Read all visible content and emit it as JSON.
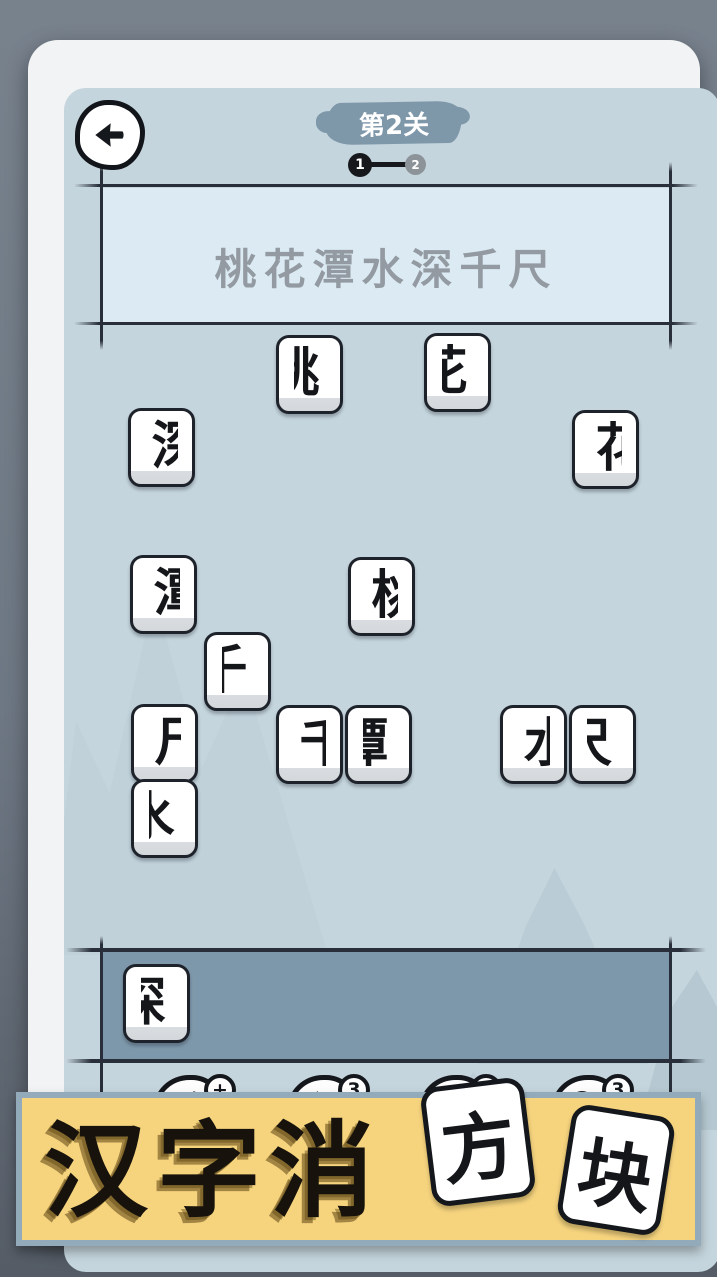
{
  "colors": {
    "screen_bg": "#c5d5dd",
    "phrase_fill": "#dcebf3",
    "tray_fill": "#7e98ab",
    "banner_bg": "#f6d47e",
    "banner_border": "#93aaba",
    "level_banner": "#7e98aa",
    "ink": "#14171c",
    "phrase_text": "#939aa2"
  },
  "header": {
    "back_icon": "arrow-left-icon",
    "level_label": "第2关",
    "progress": {
      "current": "1",
      "next": "2"
    }
  },
  "puzzle": {
    "phrase": "桃花潭水深千尺"
  },
  "board": {
    "tiles": [
      {
        "char": "桃",
        "half": "right",
        "x": 248,
        "y": 295
      },
      {
        "char": "花",
        "half": "right",
        "x": 396,
        "y": 293
      },
      {
        "char": "深",
        "half": "left",
        "x": 100,
        "y": 368
      },
      {
        "char": "花",
        "half": "left",
        "x": 544,
        "y": 370
      },
      {
        "char": "潭",
        "half": "left",
        "x": 102,
        "y": 515
      },
      {
        "char": "桃",
        "half": "left",
        "x": 320,
        "y": 517
      },
      {
        "char": "千",
        "half": "right",
        "x": 176,
        "y": 592
      },
      {
        "char": "尺",
        "half": "left",
        "x": 103,
        "y": 664
      },
      {
        "char": "千",
        "half": "left",
        "x": 248,
        "y": 665
      },
      {
        "char": "潭",
        "half": "right",
        "x": 317,
        "y": 665
      },
      {
        "char": "水",
        "half": "left",
        "x": 472,
        "y": 665
      },
      {
        "char": "尺",
        "half": "right",
        "x": 541,
        "y": 665
      },
      {
        "char": "水",
        "half": "right",
        "x": 103,
        "y": 739
      }
    ]
  },
  "tray": {
    "tiles": [
      {
        "char": "深",
        "half": "right",
        "x": 95,
        "y": 924
      }
    ]
  },
  "toolbar": {
    "buttons": [
      {
        "name": "swap",
        "icon": "swap-arrows-icon",
        "badge": "+"
      },
      {
        "name": "undo",
        "icon": "undo-arrow-icon",
        "badge": "3"
      },
      {
        "name": "add-tile",
        "icon": "plus-blocks-icon",
        "badge": "+"
      },
      {
        "name": "hint",
        "icon": "magnifier-icon",
        "badge": "3"
      }
    ]
  },
  "footer_banner": {
    "title": "汉字消",
    "tiles": [
      "方",
      "块"
    ]
  }
}
